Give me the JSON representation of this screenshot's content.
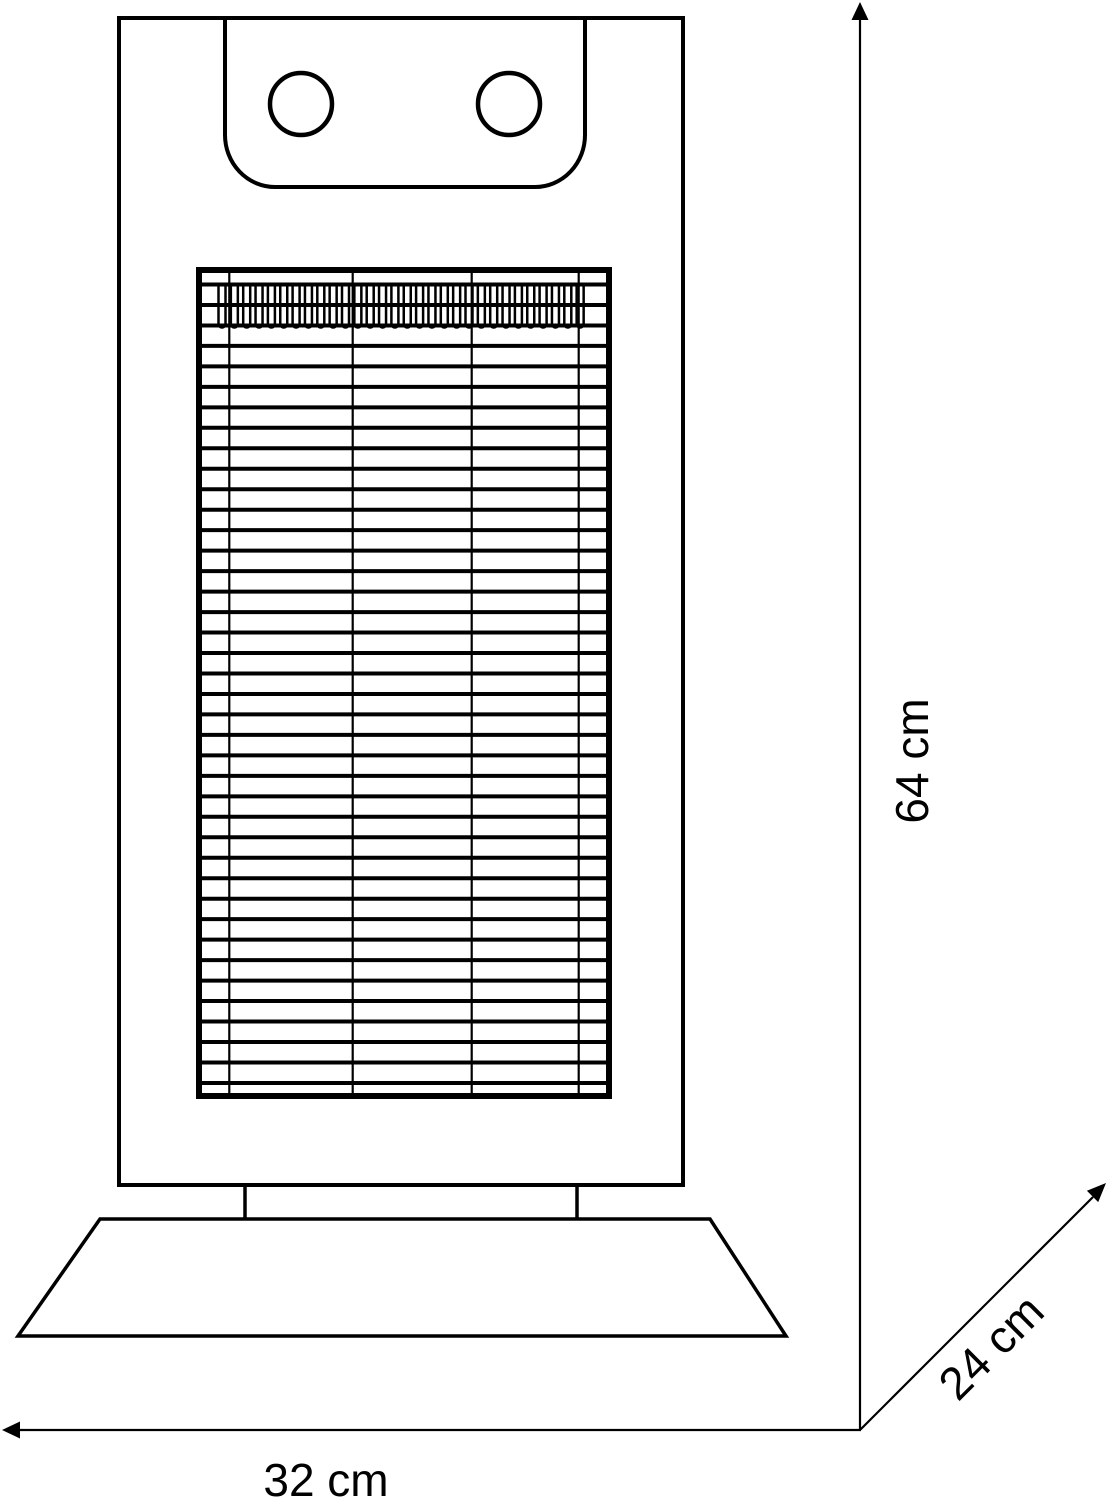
{
  "diagram": {
    "type": "technical-line-drawing",
    "subject": "tower heater front view with outer dimensions",
    "background_color": "#ffffff",
    "line_color": "#000000",
    "dimensions": {
      "height": {
        "label": "64 cm",
        "value": 64,
        "unit": "cm",
        "orientation": "vertical-right-side"
      },
      "depth": {
        "label": "24 cm",
        "value": 24,
        "unit": "cm",
        "orientation": "diagonal-bottom-right"
      },
      "width": {
        "label": "32 cm",
        "value": 32,
        "unit": "cm",
        "orientation": "horizontal-bottom"
      }
    },
    "device": {
      "parts": [
        "body-outline",
        "control-panel",
        "control-knob-left",
        "control-knob-right",
        "heating-grille",
        "heating-coils",
        "neck",
        "base-stand"
      ],
      "grille": {
        "rows": 40,
        "column_divider_positions": [
          229.3,
          352.7,
          471.7,
          578.7
        ],
        "coil_loops": 30
      },
      "knobs": {
        "count": 2
      }
    }
  }
}
